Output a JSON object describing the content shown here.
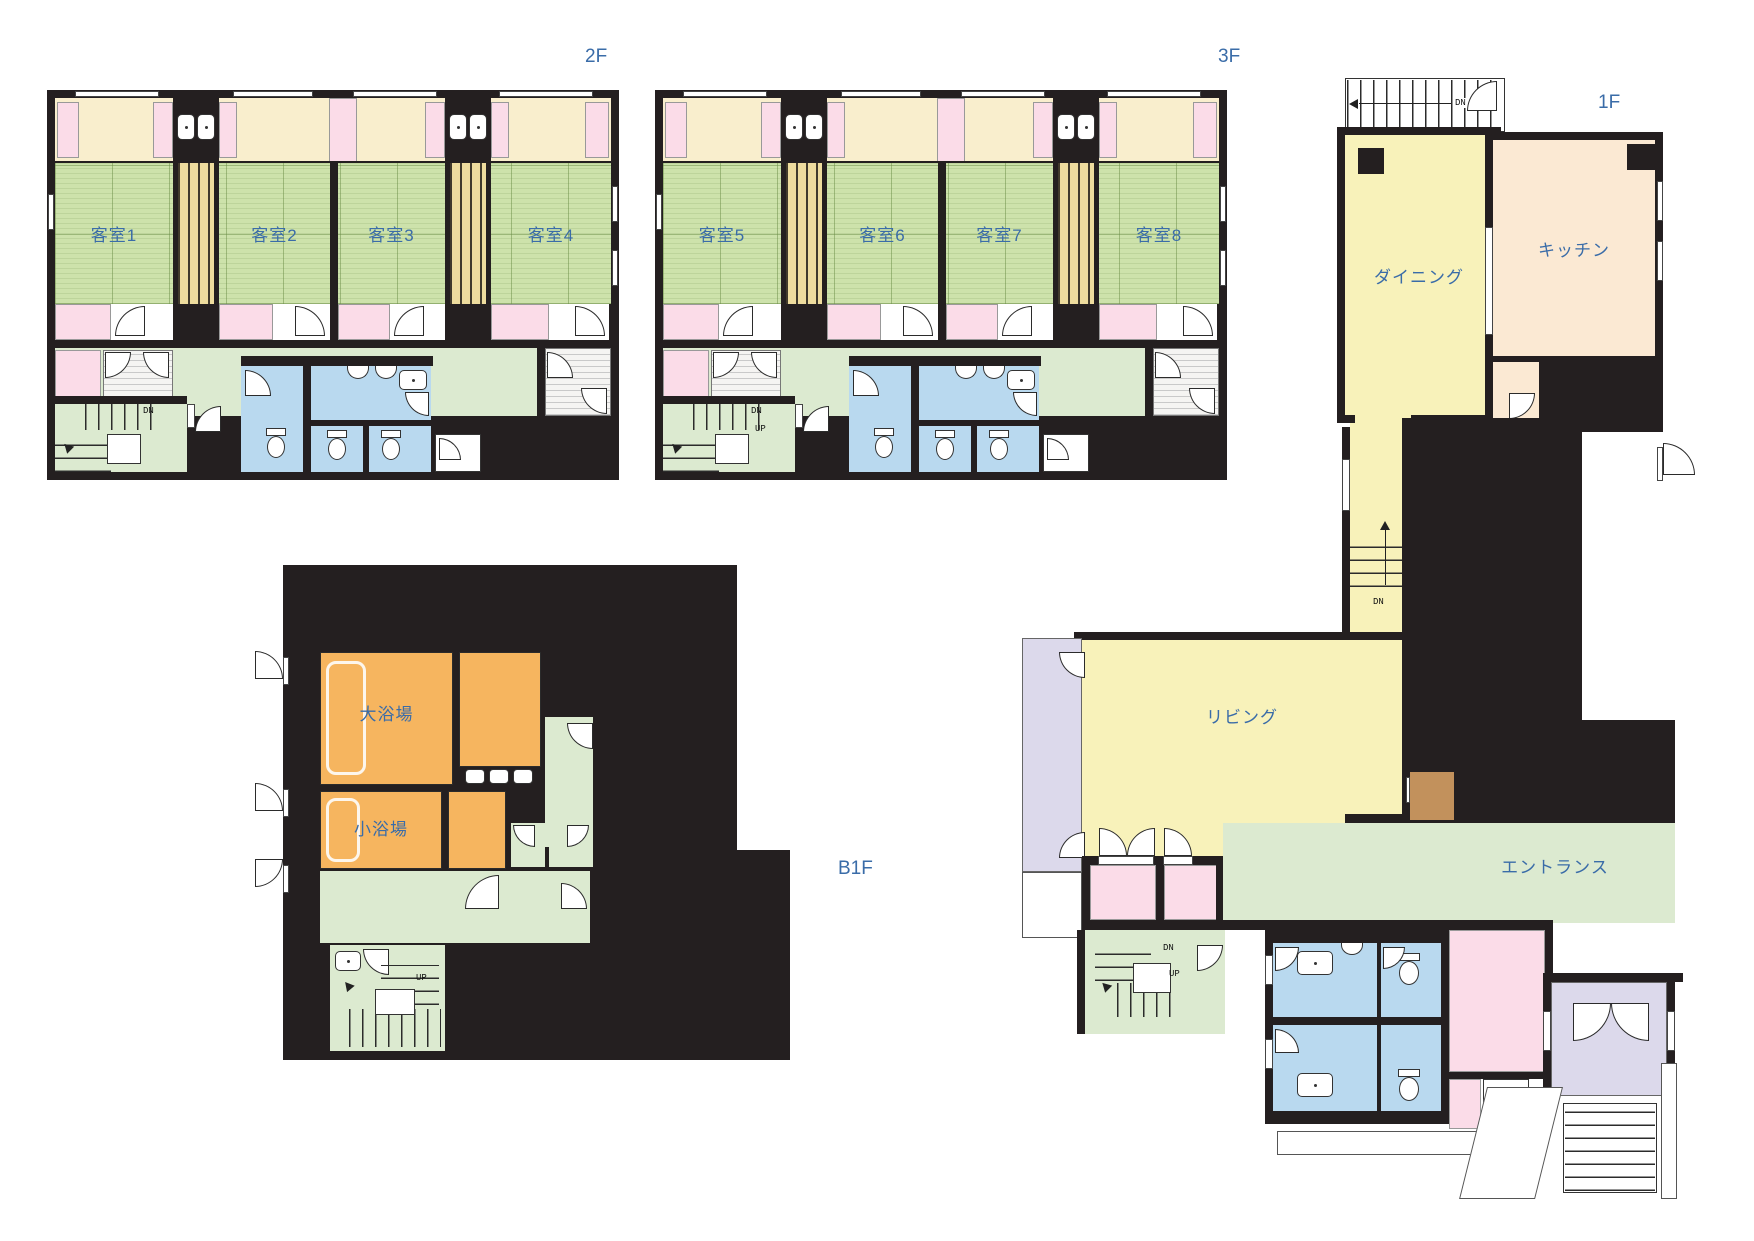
{
  "palette": {
    "wall_black": "#241f20",
    "label_blue": "#3a6ca8",
    "tatami_green": "#cde2ab",
    "corridor_green": "#dcead0",
    "balcony_cream": "#f9eecd",
    "closet_pink": "#fbdce8",
    "bathroom_blue": "#b9d9ef",
    "bath_orange": "#f6b55f",
    "living_yellow": "#f8f2ba",
    "kitchen_peach": "#fbe9d3",
    "veranda_lavender": "#dcd9eb",
    "cabinet_brown": "#c2915c",
    "shaft_tan": "#eedc9e"
  },
  "floors": {
    "f2": {
      "label": "2F",
      "rooms": {
        "r1": "客室1",
        "r2": "客室2",
        "r3": "客室3",
        "r4": "客室4"
      },
      "corridor": "廊下",
      "dn": "DN"
    },
    "f3": {
      "label": "3F",
      "rooms": {
        "r1": "客室5",
        "r2": "客室6",
        "r3": "客室7",
        "r4": "客室8"
      },
      "corridor": "廊下",
      "dn": "DN",
      "up": "UP"
    },
    "f1": {
      "label": "1F",
      "dining": "ダイニング",
      "kitchen": "キッチン",
      "living": "リビング",
      "entrance": "エントランス",
      "top_stair_dn": "DN",
      "hall_dn": "DN",
      "entry_stair_dn": "DN",
      "entry_stair_up": "UP"
    },
    "b1": {
      "label": "B1F",
      "large_bath": "大浴場",
      "small_bath": "小浴場",
      "up": "UP"
    }
  }
}
